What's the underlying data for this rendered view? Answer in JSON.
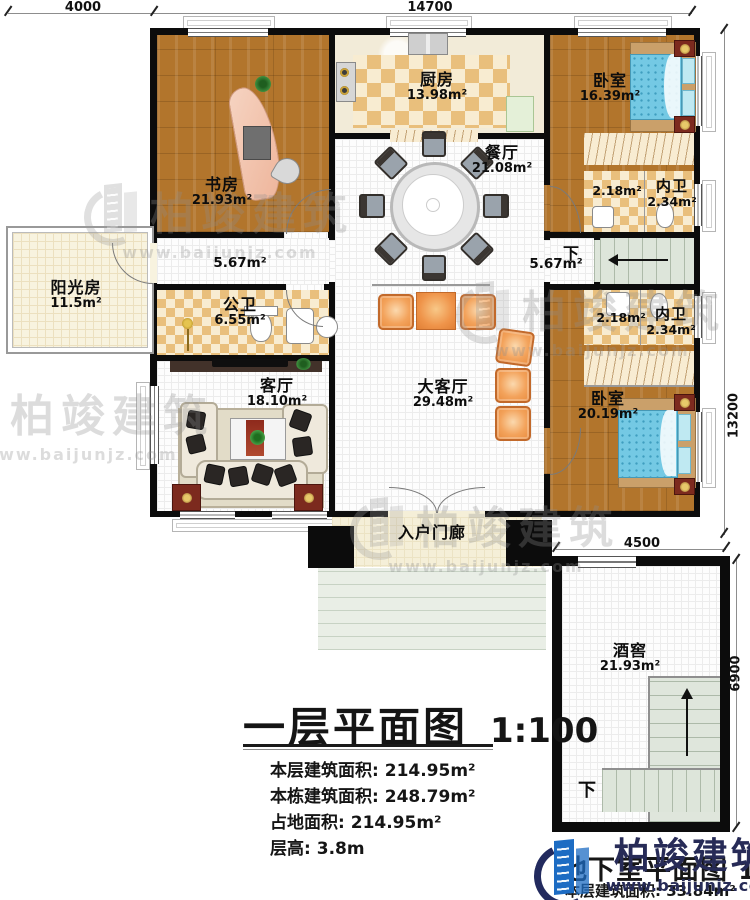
{
  "brand": {
    "name": "柏竣建筑",
    "url": "www.baijunjz.com"
  },
  "dims": {
    "d4000": "4000",
    "d14700": "14700",
    "d13200": "13200",
    "d4500": "4500",
    "d6900": "6900"
  },
  "rooms": {
    "study": {
      "name": "书房",
      "area": "21.93m²"
    },
    "kitchen": {
      "name": "厨房",
      "area": "13.98m²"
    },
    "bedroom_top": {
      "name": "卧室",
      "area": "16.39m²"
    },
    "dining": {
      "name": "餐厅",
      "area": "21.08m²"
    },
    "closet_top": {
      "area": "2.18m²"
    },
    "bath_top": {
      "name": "内卫",
      "area": "2.34m²"
    },
    "hall_left": {
      "area": "5.67m²"
    },
    "hall_right": {
      "area": "5.67m²",
      "down": "下"
    },
    "sunroom": {
      "name": "阳光房",
      "area": "11.5m²"
    },
    "bath_public": {
      "name": "公卫",
      "area": "6.55m²"
    },
    "living": {
      "name": "客厅",
      "area": "18.10m²"
    },
    "great_hall": {
      "name": "大客厅",
      "area": "29.48m²"
    },
    "closet_bottom": {
      "area": "2.18m²"
    },
    "bath_bottom": {
      "name": "内卫",
      "area": "2.34m²"
    },
    "bedroom_bottom": {
      "name": "卧室",
      "area": "20.19m²"
    },
    "porch": {
      "name": "入户门廊"
    },
    "cellar": {
      "name": "酒窖",
      "area": "21.93m²",
      "down": "下"
    }
  },
  "title_block": {
    "title": "一层平面图",
    "scale": "1:100",
    "stats": [
      {
        "label": "本层建筑面积:",
        "value": "214.95m²"
      },
      {
        "label": "本栋建筑面积:",
        "value": "248.79m²"
      },
      {
        "label": "占地面积:",
        "value": "214.95m²"
      },
      {
        "label": "层高:",
        "value": "3.8m"
      }
    ]
  },
  "basement_block": {
    "hidden_title": "地下室平面图",
    "scale": "1:100",
    "area_label": "本层建筑面积:",
    "area_value": "33.84m²"
  }
}
